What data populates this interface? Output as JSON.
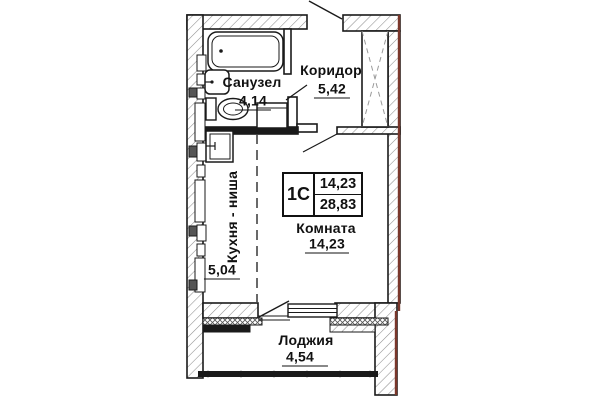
{
  "plan": {
    "unit": {
      "type": "1С",
      "living_area": "14,23",
      "total_area": "28,83"
    },
    "rooms": {
      "bathroom": {
        "name": "Санузел",
        "area": "4,14"
      },
      "corridor": {
        "name": "Коридор",
        "area": "5,42"
      },
      "kitchen_niche": {
        "name": "Кухня - ниша",
        "area": "5,04"
      },
      "room": {
        "name": "Комната",
        "area": "14,23"
      },
      "loggia": {
        "name": "Лоджия",
        "area": "4,54"
      }
    },
    "fixtures": [
      "bathtub",
      "bath-sink",
      "toilet",
      "washing-machine",
      "kitchen-sink",
      "ventilation-shaft"
    ],
    "colors": {
      "line": "#1a1a1a",
      "hatch": "#8f8f8f",
      "accent_red": "#7a372b",
      "background": "#ffffff"
    }
  }
}
